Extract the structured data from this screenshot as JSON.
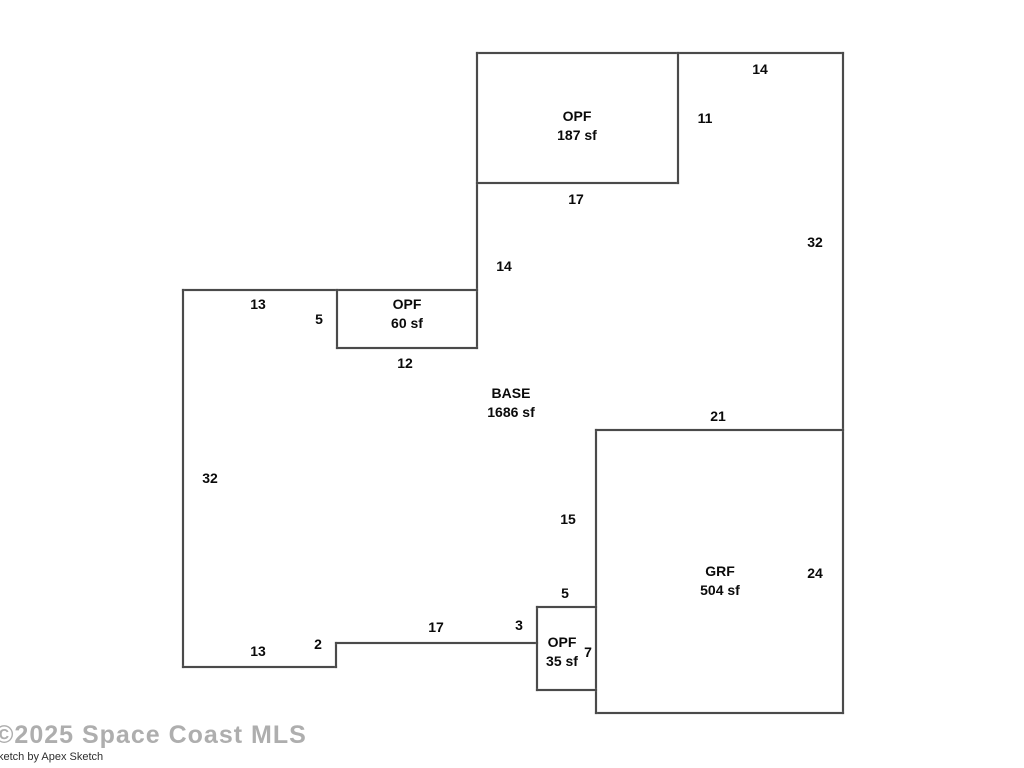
{
  "floorplan": {
    "wall_color": "#4a4a4a",
    "label_color": "#0a0a0a",
    "areas": [
      {
        "name": "OPF",
        "area": "187 sf",
        "cx": 577,
        "cy": 126
      },
      {
        "name": "OPF",
        "area": "60 sf",
        "cx": 407,
        "cy": 314
      },
      {
        "name": "BASE",
        "area": "1686 sf",
        "cx": 511,
        "cy": 403
      },
      {
        "name": "GRF",
        "area": "504 sf",
        "cx": 720,
        "cy": 581
      },
      {
        "name": "OPF",
        "area": "35 sf",
        "cx": 562,
        "cy": 652
      }
    ],
    "dimensions": [
      {
        "value": "14",
        "x": 760,
        "y": 69
      },
      {
        "value": "11",
        "x": 705,
        "y": 118
      },
      {
        "value": "17",
        "x": 576,
        "y": 199
      },
      {
        "value": "32",
        "x": 815,
        "y": 242
      },
      {
        "value": "14",
        "x": 504,
        "y": 266
      },
      {
        "value": "13",
        "x": 258,
        "y": 304
      },
      {
        "value": "5",
        "x": 319,
        "y": 319
      },
      {
        "value": "12",
        "x": 405,
        "y": 363
      },
      {
        "value": "21",
        "x": 718,
        "y": 416
      },
      {
        "value": "32",
        "x": 210,
        "y": 478
      },
      {
        "value": "15",
        "x": 568,
        "y": 519
      },
      {
        "value": "24",
        "x": 815,
        "y": 573
      },
      {
        "value": "5",
        "x": 565,
        "y": 593
      },
      {
        "value": "3",
        "x": 519,
        "y": 625
      },
      {
        "value": "17",
        "x": 436,
        "y": 627
      },
      {
        "value": "2",
        "x": 318,
        "y": 644
      },
      {
        "value": "13",
        "x": 258,
        "y": 651
      },
      {
        "value": "7",
        "x": 588,
        "y": 652
      }
    ],
    "walls": [
      [
        477,
        53,
        843,
        53
      ],
      [
        843,
        53,
        843,
        713
      ],
      [
        596,
        713,
        843,
        713
      ],
      [
        596,
        430,
        596,
        713
      ],
      [
        596,
        430,
        843,
        430
      ],
      [
        477,
        53,
        477,
        348
      ],
      [
        477,
        183,
        678,
        183
      ],
      [
        678,
        53,
        678,
        183
      ],
      [
        183,
        290,
        477,
        290
      ],
      [
        337,
        290,
        337,
        348
      ],
      [
        337,
        348,
        477,
        348
      ],
      [
        183,
        290,
        183,
        667
      ],
      [
        183,
        667,
        336,
        667
      ],
      [
        336,
        643,
        336,
        667
      ],
      [
        336,
        643,
        537,
        643
      ],
      [
        537,
        607,
        537,
        690
      ],
      [
        537,
        607,
        596,
        607
      ],
      [
        537,
        690,
        596,
        690
      ]
    ]
  },
  "watermark": {
    "copyright": "©2025 Space Coast MLS",
    "credit": "ketch by Apex Sketch"
  }
}
